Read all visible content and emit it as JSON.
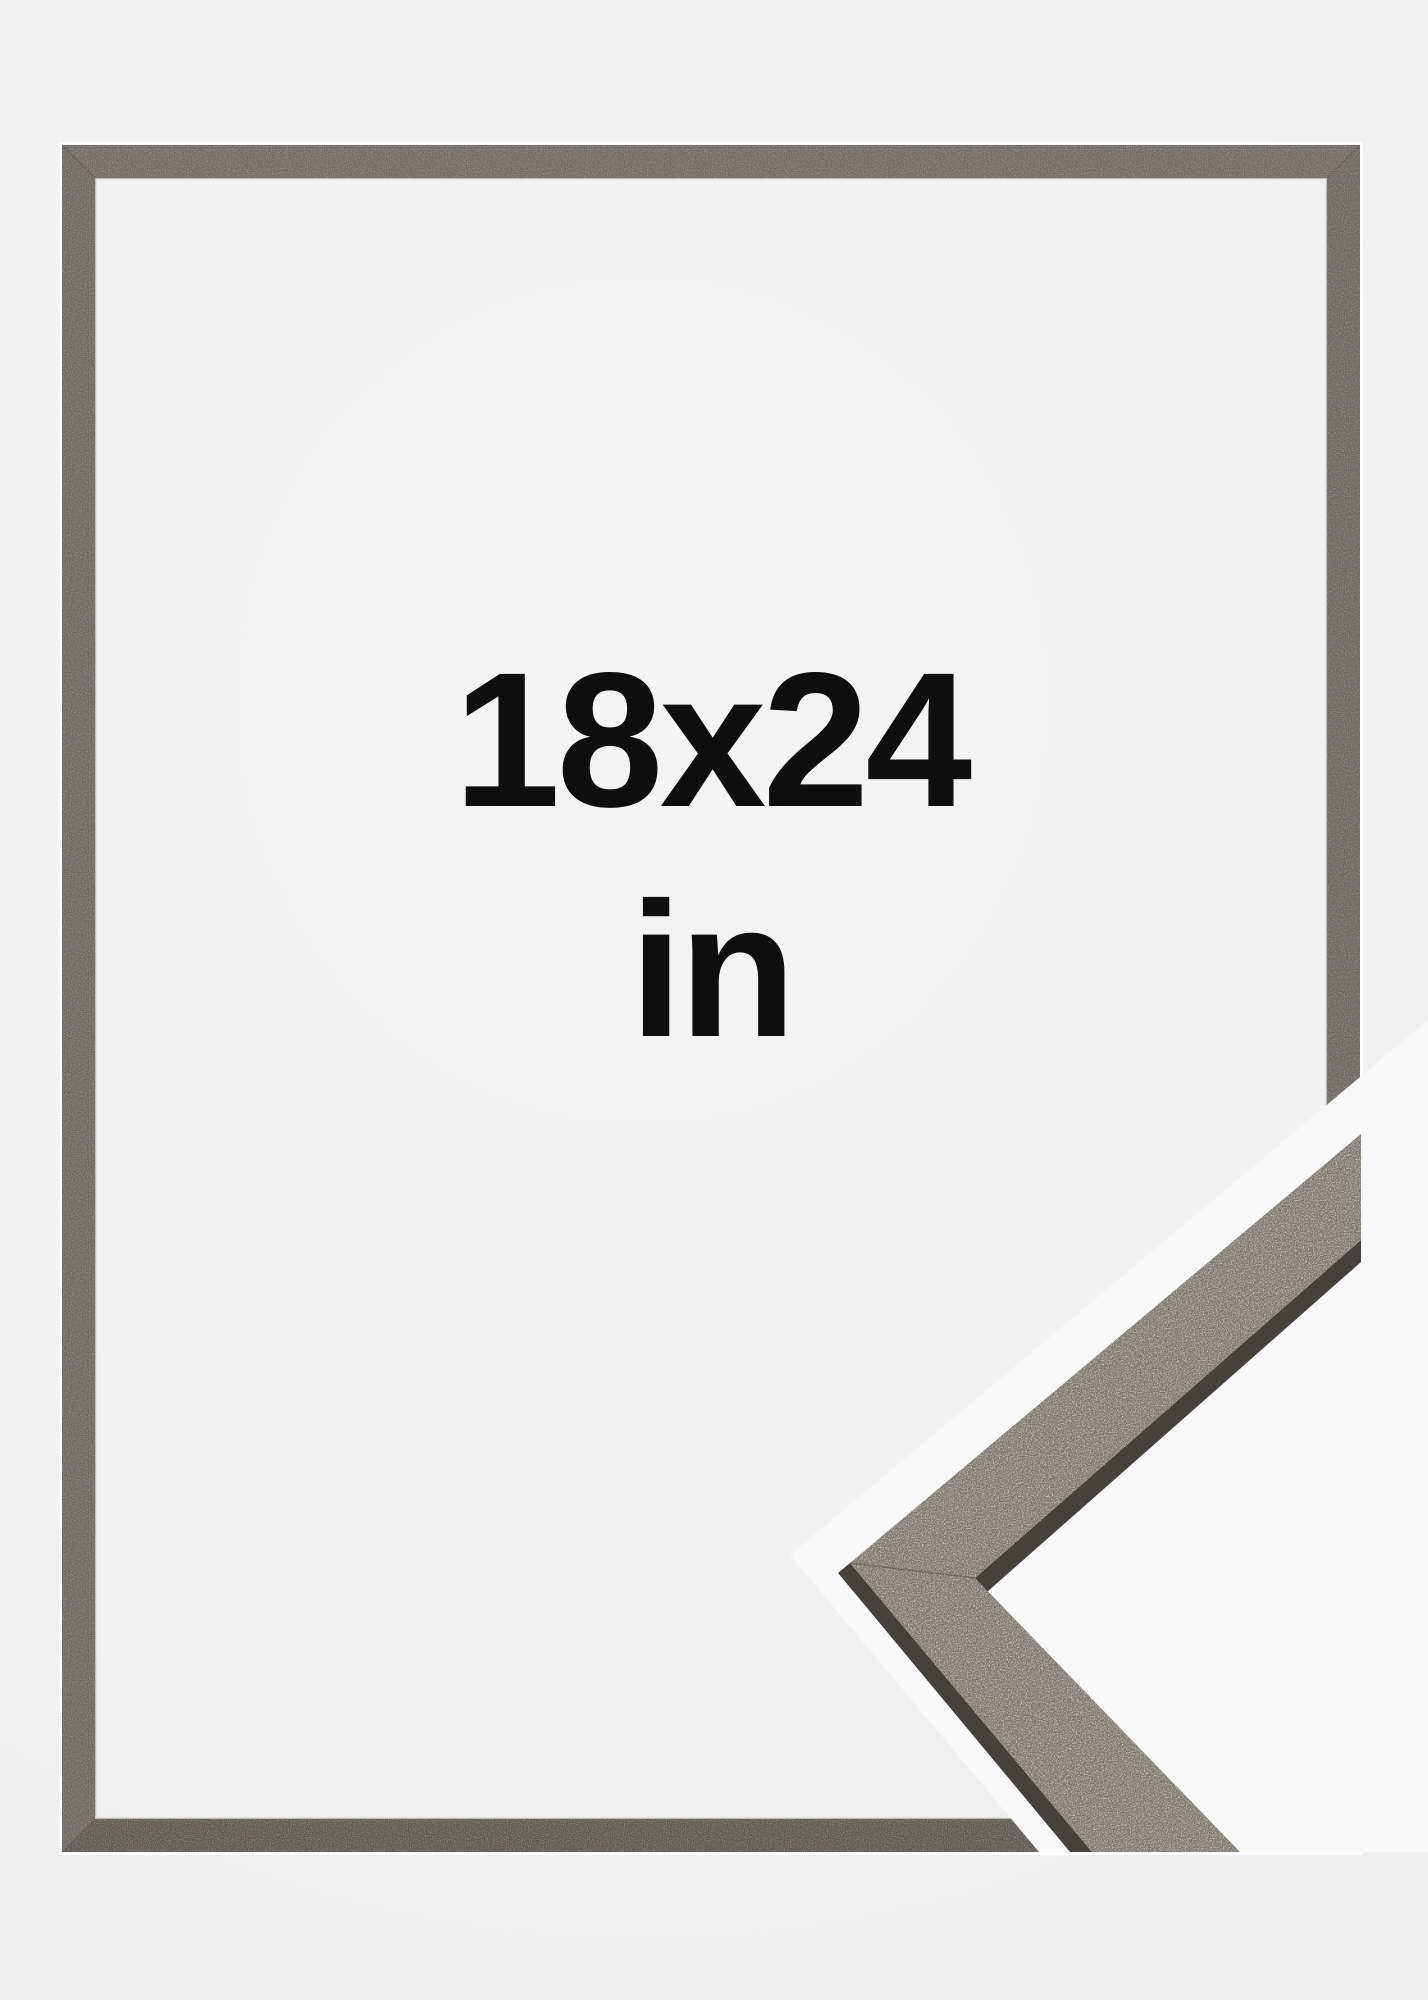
{
  "product_image": {
    "size_label": {
      "line1": "18x24",
      "line2": "in"
    },
    "colors": {
      "background": "#f1f1f1",
      "text": "#0e0e0e",
      "frame_top": "#6f6a64",
      "frame_right": "#6b6660",
      "frame_bottom": "#5b5752",
      "frame_left": "#6d6862",
      "frame_outer_highlight": "#ffffff",
      "frame_inner_highlight": "#938e88",
      "frame_miter_seam": "#2b2926",
      "sample_halo": "#f8f8f8",
      "sample_face": "#797570",
      "sample_side_edge": "#45423e",
      "sample_miter_seam": "#3c3a37"
    }
  }
}
